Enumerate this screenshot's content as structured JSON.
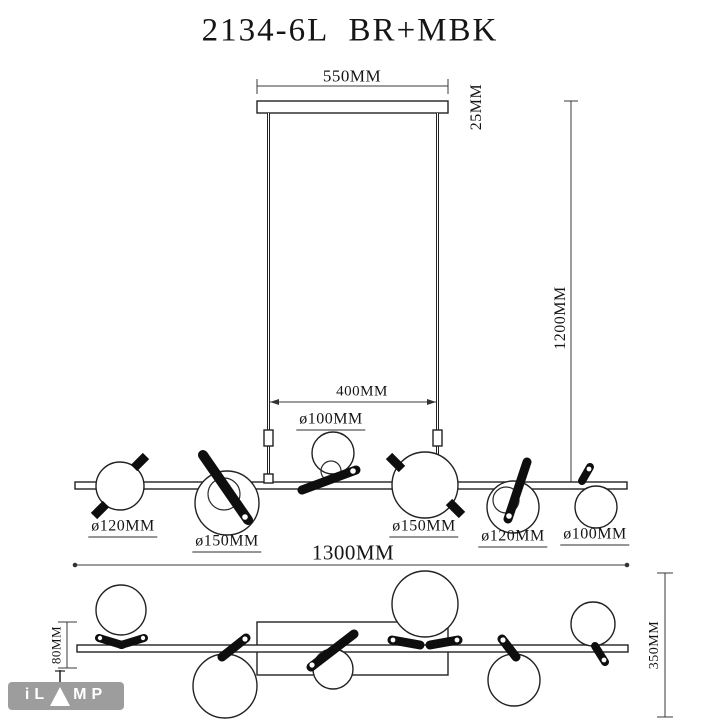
{
  "title": "2134-6L  BR+MBK",
  "page": {
    "background": "#ffffff",
    "line_color": "#222222",
    "dim_line_color": "#3a3a3a",
    "fixture_black": "#0e0e0e"
  },
  "side_view": {
    "dim_canopy_width": "550MM",
    "dim_canopy_thickness": "25MM",
    "dim_drop_height": "1200MM",
    "dim_rod_spacing": "400MM",
    "dim_total_length": "1300MM",
    "shade_top_label": "ø100MM",
    "shades": [
      "ø120MM",
      "ø150MM",
      "ø150MM",
      "ø120MM",
      "ø100MM"
    ]
  },
  "plan_view": {
    "dim_bar_height": "80MM",
    "dim_plan_depth": "350MM"
  },
  "brand": {
    "text_left": "iL",
    "text_right": "MP",
    "logo_bg": "#9d9d9d",
    "logo_text_color": "#ffffff"
  }
}
